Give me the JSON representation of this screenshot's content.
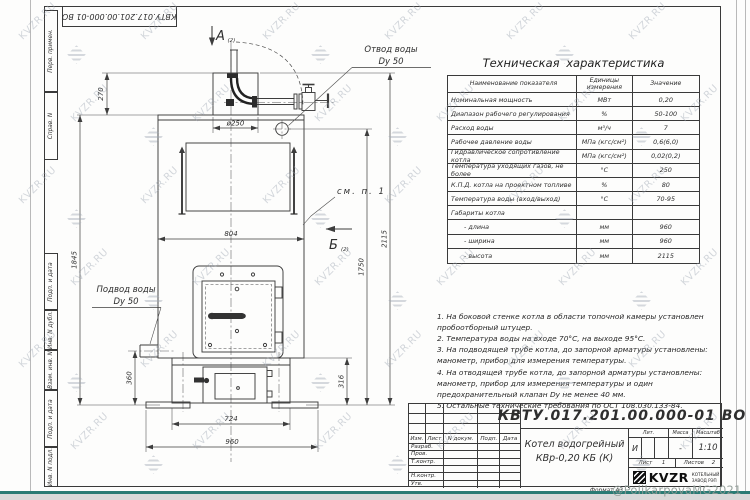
{
  "watermark": {
    "text": "KVZR.RU",
    "credit": "@PolikarpovaMG2021"
  },
  "stamp_top": "КВТУ.017.201.00.000-01 ВО",
  "frame_fields": [
    "Перв. примен.",
    "Справ. N",
    "Подп. и дата",
    "Инв. N дубл.",
    "Взам. инв. N",
    "Подп. и дата",
    "Инв. N подл."
  ],
  "drawing": {
    "view_a": "А",
    "view_a_sheet": "(2)",
    "view_b": "Б",
    "view_b_sheet": "(2)",
    "label_outlet_1": "Отвод воды",
    "label_outlet_2": "Dy 50",
    "label_inlet_1": "Подвод воды",
    "label_inlet_2": "Dy 50",
    "label_see_note": "см. п. 1",
    "dims": {
      "d250": "ø250",
      "h270": "270",
      "w804": "804",
      "h1845": "1845",
      "h1750": "1750",
      "h2115": "2115",
      "h360": "360",
      "h316": "316",
      "w724": "724",
      "w960": "960"
    }
  },
  "tech_table": {
    "title": "Техническая характеристика",
    "headers": [
      "Наименование показателя",
      "Единицы измерения",
      "Значение"
    ],
    "rows": [
      [
        "Номинальная мощность",
        "МВт",
        "0,20"
      ],
      [
        "Диапазон рабочего регулирования",
        "%",
        "50-100"
      ],
      [
        "Расход воды",
        "м³/ч",
        "7"
      ],
      [
        "Рабочее давление воды",
        "МПа (кгс/см²)",
        "0,6(6,0)"
      ],
      [
        "Гидравлическое сопротивление котла",
        "МПа (кгс/см²)",
        "0,02(0,2)"
      ],
      [
        "Температура уходящих газов, не более",
        "°С",
        "250"
      ],
      [
        "К.П.Д. котла на проектном топливе",
        "%",
        "80"
      ],
      [
        "Температура воды (вход/выход)",
        "°С",
        "70-95"
      ],
      [
        "Габариты котла",
        "",
        ""
      ],
      [
        "- длина",
        "мм",
        "960"
      ],
      [
        "- ширина",
        "мм",
        "960"
      ],
      [
        "- высота",
        "мм",
        "2115"
      ]
    ]
  },
  "notes": [
    "1. На боковой стенке котла в области топочной камеры установлен пробоотборный штуцер.",
    "2. Температура воды на входе 70°С, на выходе 95°С.",
    "3. На подводящей трубе котла, до запорной арматуры установлены: манометр, прибор для измерения температуры.",
    "4. На отводящей трубе котла, до запорной арматуры установлены: манометр, прибор для измерения температуры и один предохранительный клапан Dу не менее 40 мм.",
    "5. Остальные технические требования по ОСТ 108.030.133-84."
  ],
  "title_block": {
    "doc_number": "КВТУ.017.201.00.000-01 ВО",
    "header_cells": [
      "Изм.",
      "Лист",
      "N докум.",
      "Подп.",
      "Дата"
    ],
    "rows_left": [
      "Разраб.",
      "Пров.",
      "Т.контр.",
      "",
      "Н.контр.",
      "Утв."
    ],
    "product_title_1": "Котел водогрейный",
    "product_title_2": "КВр-0,20 КБ (К)",
    "lit_label": "Лит.",
    "lit_value": "И",
    "mass_label": "Масса",
    "mass_value": "-",
    "scale_label": "Масштаб",
    "scale_value": "1:10",
    "sheet_label": "Лист",
    "sheet_value": "1",
    "sheets_label": "Листов",
    "sheets_value": "2",
    "logo_brand": "KVZR",
    "logo_caption_1": "КОТЕЛЬНЫЙ",
    "logo_caption_2": "ЗАВОД РЭП",
    "format_label": "Формат А3"
  }
}
